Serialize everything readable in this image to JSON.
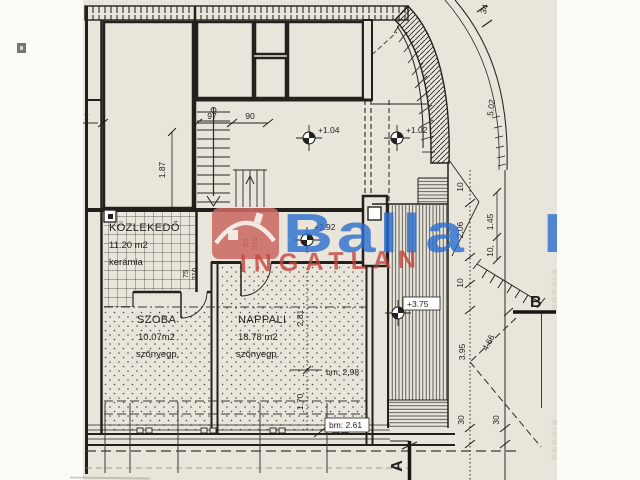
{
  "plan": {
    "rooms": {
      "kozlekedo": {
        "name": "KÖZLEKEDŐ",
        "area": "11.20 m2",
        "floor": "kerámia"
      },
      "szoba": {
        "name": "SZOBA",
        "area": "10.07m2",
        "floor": "szőnyegp."
      },
      "nappali": {
        "name": "NAPPALI",
        "area": "18.78 m2",
        "floor": "szőnyegp."
      }
    },
    "elevations": {
      "upper_room": "+1.04",
      "balcony": "+1.02",
      "entry": "+2.92",
      "terrace": "+3.75"
    },
    "dimensions": {
      "stair_left": "97",
      "stair_right": "90",
      "left_room_height": "1.87",
      "left_margin_cut": "7",
      "nappali_upper": "2.81",
      "nappali_lower": "1.70",
      "bm_upper": "bm: 2.98",
      "bm_lower": "bm: 2.61",
      "arc_width": "34",
      "arc_length": "5.02",
      "r10_top": "10",
      "r206": "2.06",
      "r145": "1.45",
      "r10_mid": "10,",
      "r10_low": "10",
      "r395": "3.95",
      "r466": "4.66",
      "r30_left": "30",
      "r30_right": "30"
    },
    "doors": {
      "szoba_door": {
        "width": "75",
        "height": "210"
      },
      "nappali_door": {
        "width": "85",
        "height": "210"
      }
    },
    "sections": {
      "a": "A",
      "b": "B"
    }
  },
  "watermark": {
    "brand": "Balla",
    "brand_fragment": "B",
    "subtitle": "INGATLAN"
  },
  "artifacts": {
    "bleed_text_1": "előadó",
    "bleed_text_2": "előadó"
  },
  "colors": {
    "paper": "#e9e5da",
    "ink": "#22211e",
    "watermark_blue": "#2a6fd0",
    "watermark_red_text": "#c6423c",
    "watermark_red_box": "#ca6a62"
  }
}
